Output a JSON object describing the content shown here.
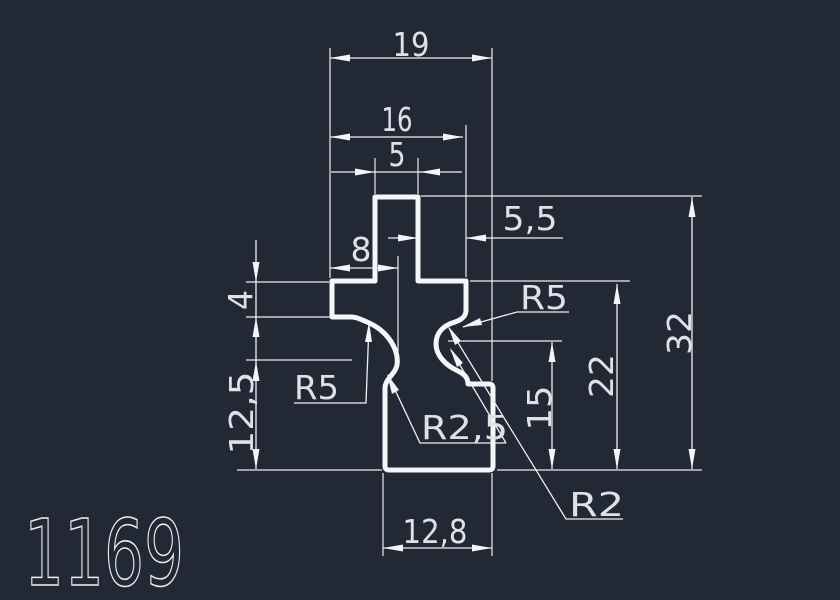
{
  "drawing": {
    "part_number": "1169",
    "dims": {
      "overall_width": "19",
      "arms_width": "16",
      "stub_width": "5",
      "stub_offset_right": "5,5",
      "neck_offset": "8",
      "arm_thickness": "4",
      "lower_height": "12,5",
      "neck_height": "15",
      "arm_height": "22",
      "overall_height": "32",
      "base_width": "12,8"
    },
    "radii": {
      "cove_left": "R5",
      "cove_right": "R5",
      "flare": "R2,5",
      "fillet": "R2"
    },
    "colors": {
      "background": "#222934",
      "line": "#f2f4f7",
      "dim_text": "#dde2e9"
    }
  }
}
